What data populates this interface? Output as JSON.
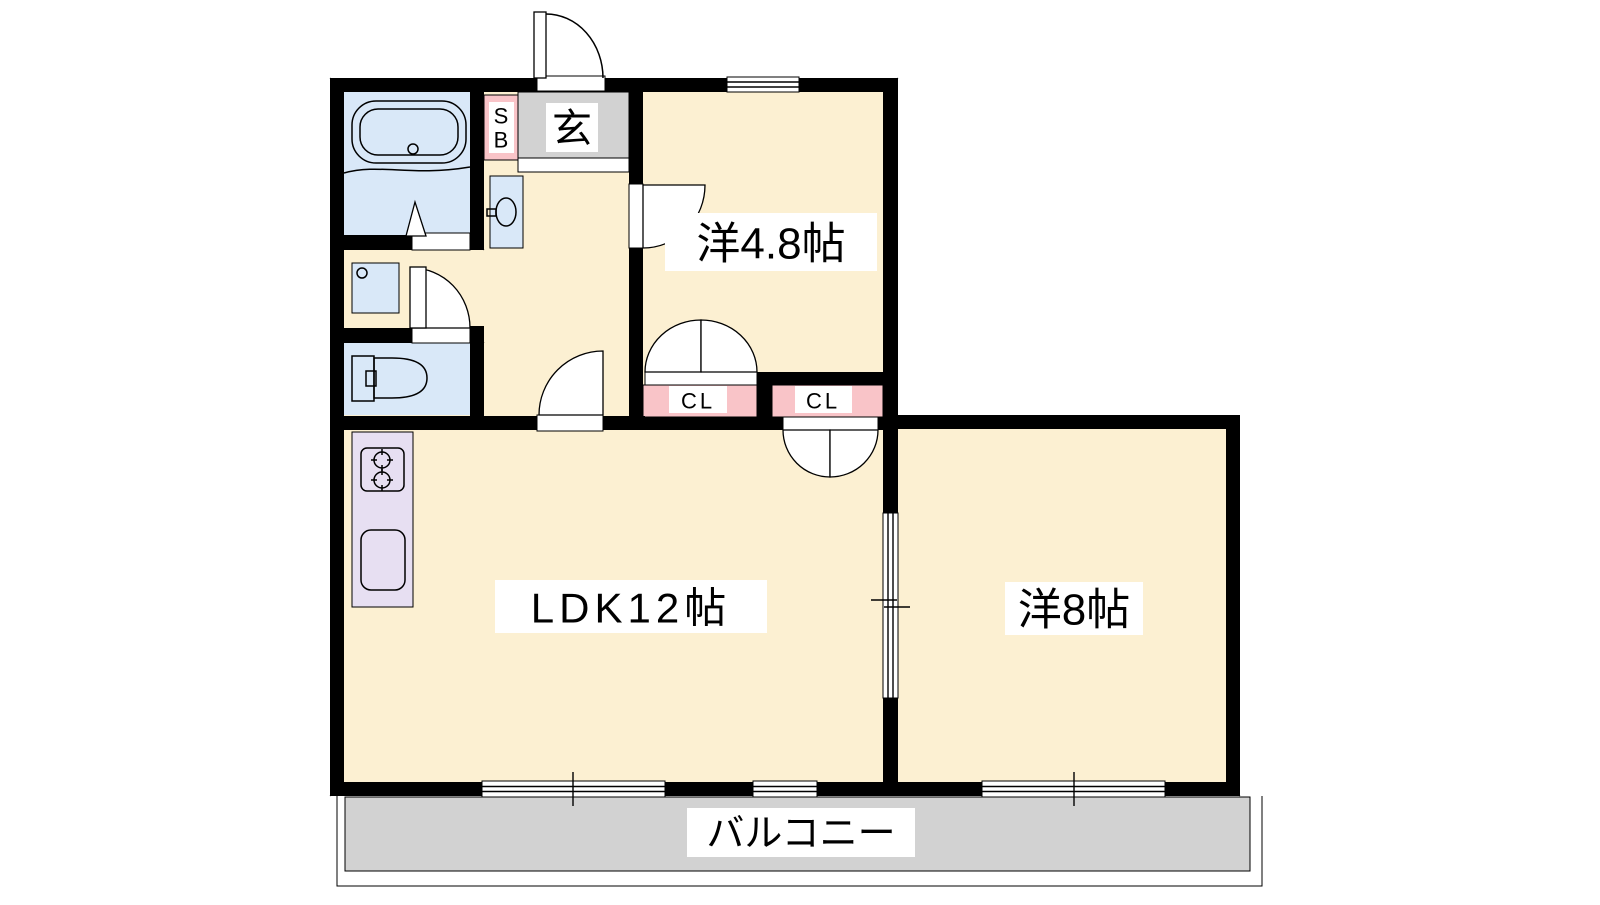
{
  "floorplan": {
    "labels": {
      "genkan": "玄",
      "shoe_box_top": "S",
      "shoe_box_bottom": "B",
      "closet_left": "CL",
      "closet_right": "CL",
      "room_west_48": "洋4.8帖",
      "ldk": "LDK12帖",
      "room_west_8": "洋8帖",
      "balcony": "バルコニー"
    },
    "colors": {
      "floor_cream": "#fcf0d2",
      "wet_blue": "#d9e8f8",
      "genkan_gray": "#d2d2d2",
      "closet_pink": "#f9c4c8",
      "kitchen_lavender": "#e7dff2",
      "wall_black": "#000000",
      "label_bg": "#ffffff"
    }
  }
}
